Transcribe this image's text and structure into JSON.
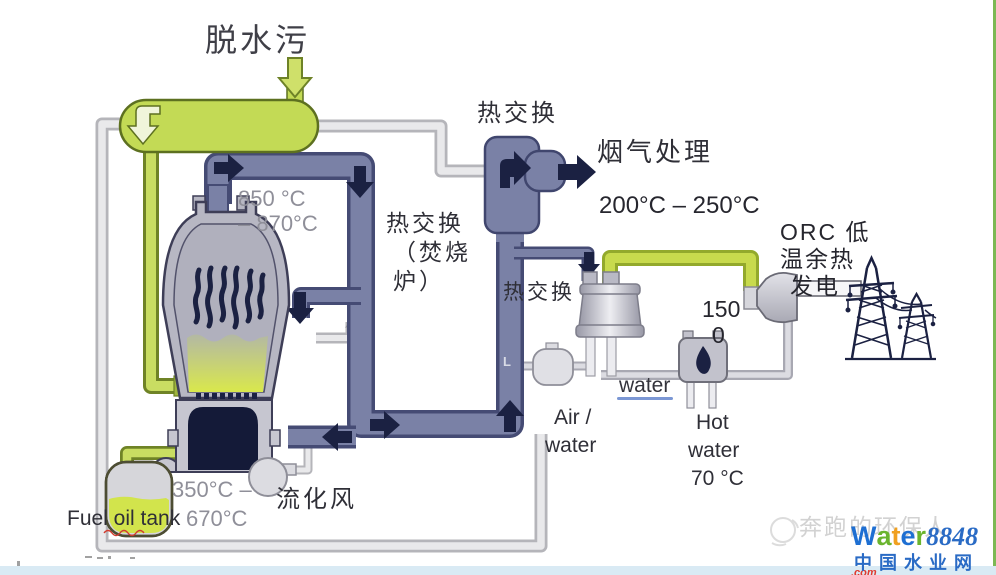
{
  "diagram": {
    "title": "脱水污",
    "labels": {
      "hx_top": "热交换",
      "flue_treatment": "烟气处理",
      "flue_range": "200°C – 250°C",
      "temp_850": "850 °C",
      "temp_870": "– 870°C",
      "hx_furnace_l1": "热交换",
      "hx_furnace_l2": "（焚烧",
      "hx_furnace_l3": "炉）",
      "hx_mid": "热交换",
      "orc_l1": "ORC 低",
      "orc_l2": "温余热",
      "orc_l3": "发电",
      "t1500_l1": "150",
      "t1500_l2": "0",
      "water": "water",
      "air_l1": "Air /",
      "air_l2": "water",
      "hot_l1": "Hot",
      "hot_l2": "water",
      "hot_l3": "70 °C",
      "tank_range_l1": "350°C –",
      "tank_range_l2": "670°C",
      "fuel_tank": "Fuel oil tank",
      "fluidizing": "流化风",
      "mark_L": "L"
    },
    "watermark": {
      "runner": "奔跑的环保人",
      "b_w": "W",
      "b_a": "a",
      "b_t": "t",
      "b_e": "e",
      "b_r": "r",
      "num": "8848",
      "com": ".com",
      "site": "中国水业网"
    },
    "colors": {
      "pipe_dark": "#7a81a6",
      "pipe_dark_border": "#454b74",
      "arrow_navy": "#1b2142",
      "pipe_light": "#e9e9eb",
      "pipe_light_border": "#b5b5ba",
      "green_fill": "#c3da55",
      "green_border": "#6f8326",
      "orc_pipe": "#c8da4d",
      "text_dark": "#26262e",
      "text_gray": "#8f8f99",
      "brand_blue": "#2a6bc5",
      "edge_green": "#7cb854",
      "bottom_strip": "#d9eaf4"
    }
  }
}
